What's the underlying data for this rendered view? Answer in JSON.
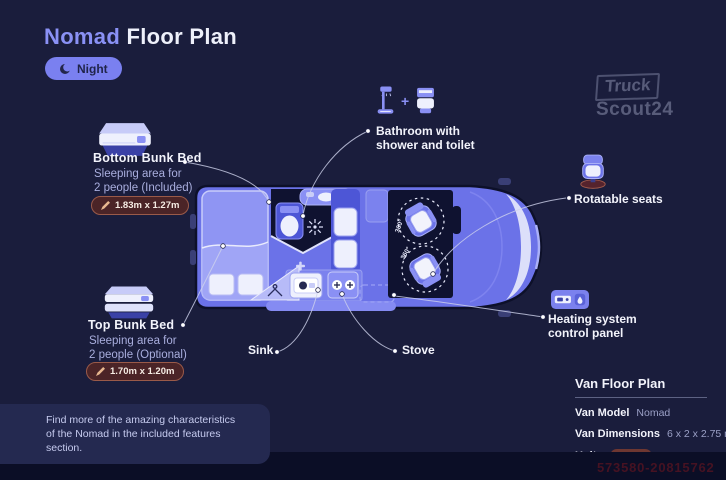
{
  "title": {
    "brand": "Nomad",
    "rest": "Floor Plan"
  },
  "mode_toggle": {
    "label": "Night",
    "icon": "moon"
  },
  "logo": {
    "line1": "Truck",
    "line2": "Scout24"
  },
  "features": {
    "bottom_bunk": {
      "title": "Bottom Bunk Bed",
      "desc1": "Sleeping area for",
      "desc2": "2 people (Included)",
      "dimensions": "1.83m x 1.27m"
    },
    "top_bunk": {
      "title": "Top Bunk Bed",
      "desc1": "Sleeping area for",
      "desc2": "2 people (Optional)",
      "dimensions": "1.70m x 1.20m"
    },
    "bathroom": {
      "line1": "Bathroom with",
      "line2": "shower and toilet",
      "plus": "+"
    },
    "rotatable_seats": {
      "label": "Rotatable seats"
    },
    "heating": {
      "line1": "Heating system",
      "line2": "control panel"
    },
    "sink": {
      "label": "Sink"
    },
    "stove": {
      "label": "Stove"
    }
  },
  "van": {
    "rotation_label": "360°"
  },
  "info_panel": {
    "heading": "Van Floor Plan",
    "rows": [
      {
        "label": "Van Model",
        "value": "Nomad"
      },
      {
        "label": "Van Dimensions",
        "value": "6 x 2 x 2.75 m"
      },
      {
        "label": "Units",
        "value": "Meter"
      }
    ]
  },
  "note": {
    "line1": "Find more of the amazing characteristics",
    "line2": "of the Nomad in the included features section."
  },
  "watermark_number": "573580-20815762",
  "colors": {
    "background": "#1a1d3c",
    "accent": "#7a80f0",
    "van_body": "#6b72e8",
    "badge": "#4b2427",
    "white": "#f2f3fb"
  }
}
